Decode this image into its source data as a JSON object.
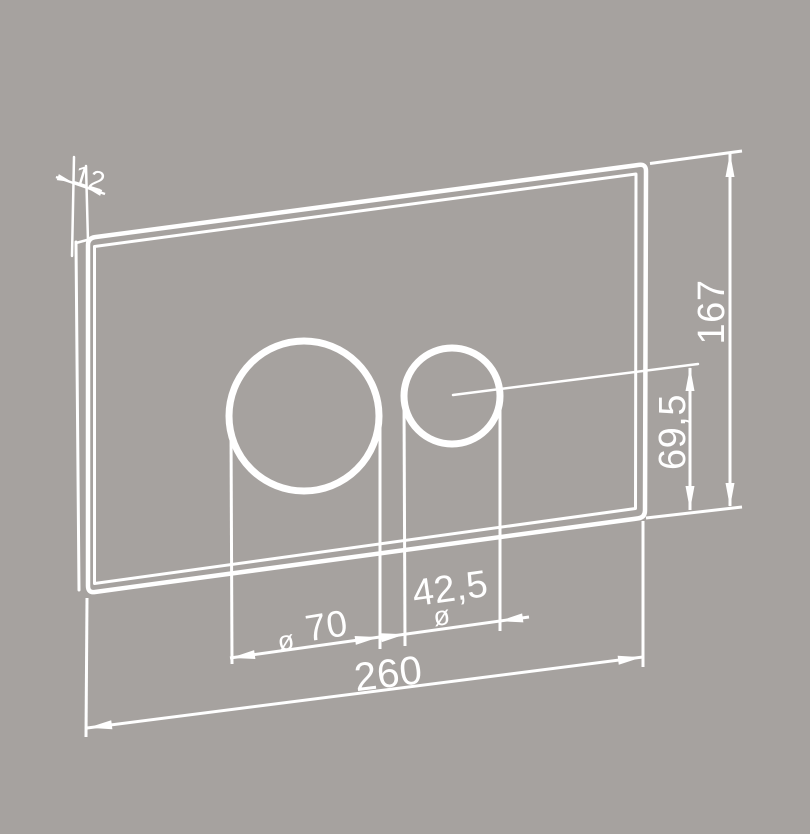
{
  "meta": {
    "description": "Technical dimension drawing of a rectangular flush plate with two circular button openings, shown in slight perspective",
    "background_color": "#a6a29f",
    "line_color": "#ffffff"
  },
  "labels": {
    "thickness": "12",
    "height": "167",
    "button_axis_height": "69,5",
    "large_button": {
      "prefix": "ø",
      "value": "70"
    },
    "small_button": {
      "prefix": "ø",
      "value": "42,5"
    },
    "width": "260"
  }
}
